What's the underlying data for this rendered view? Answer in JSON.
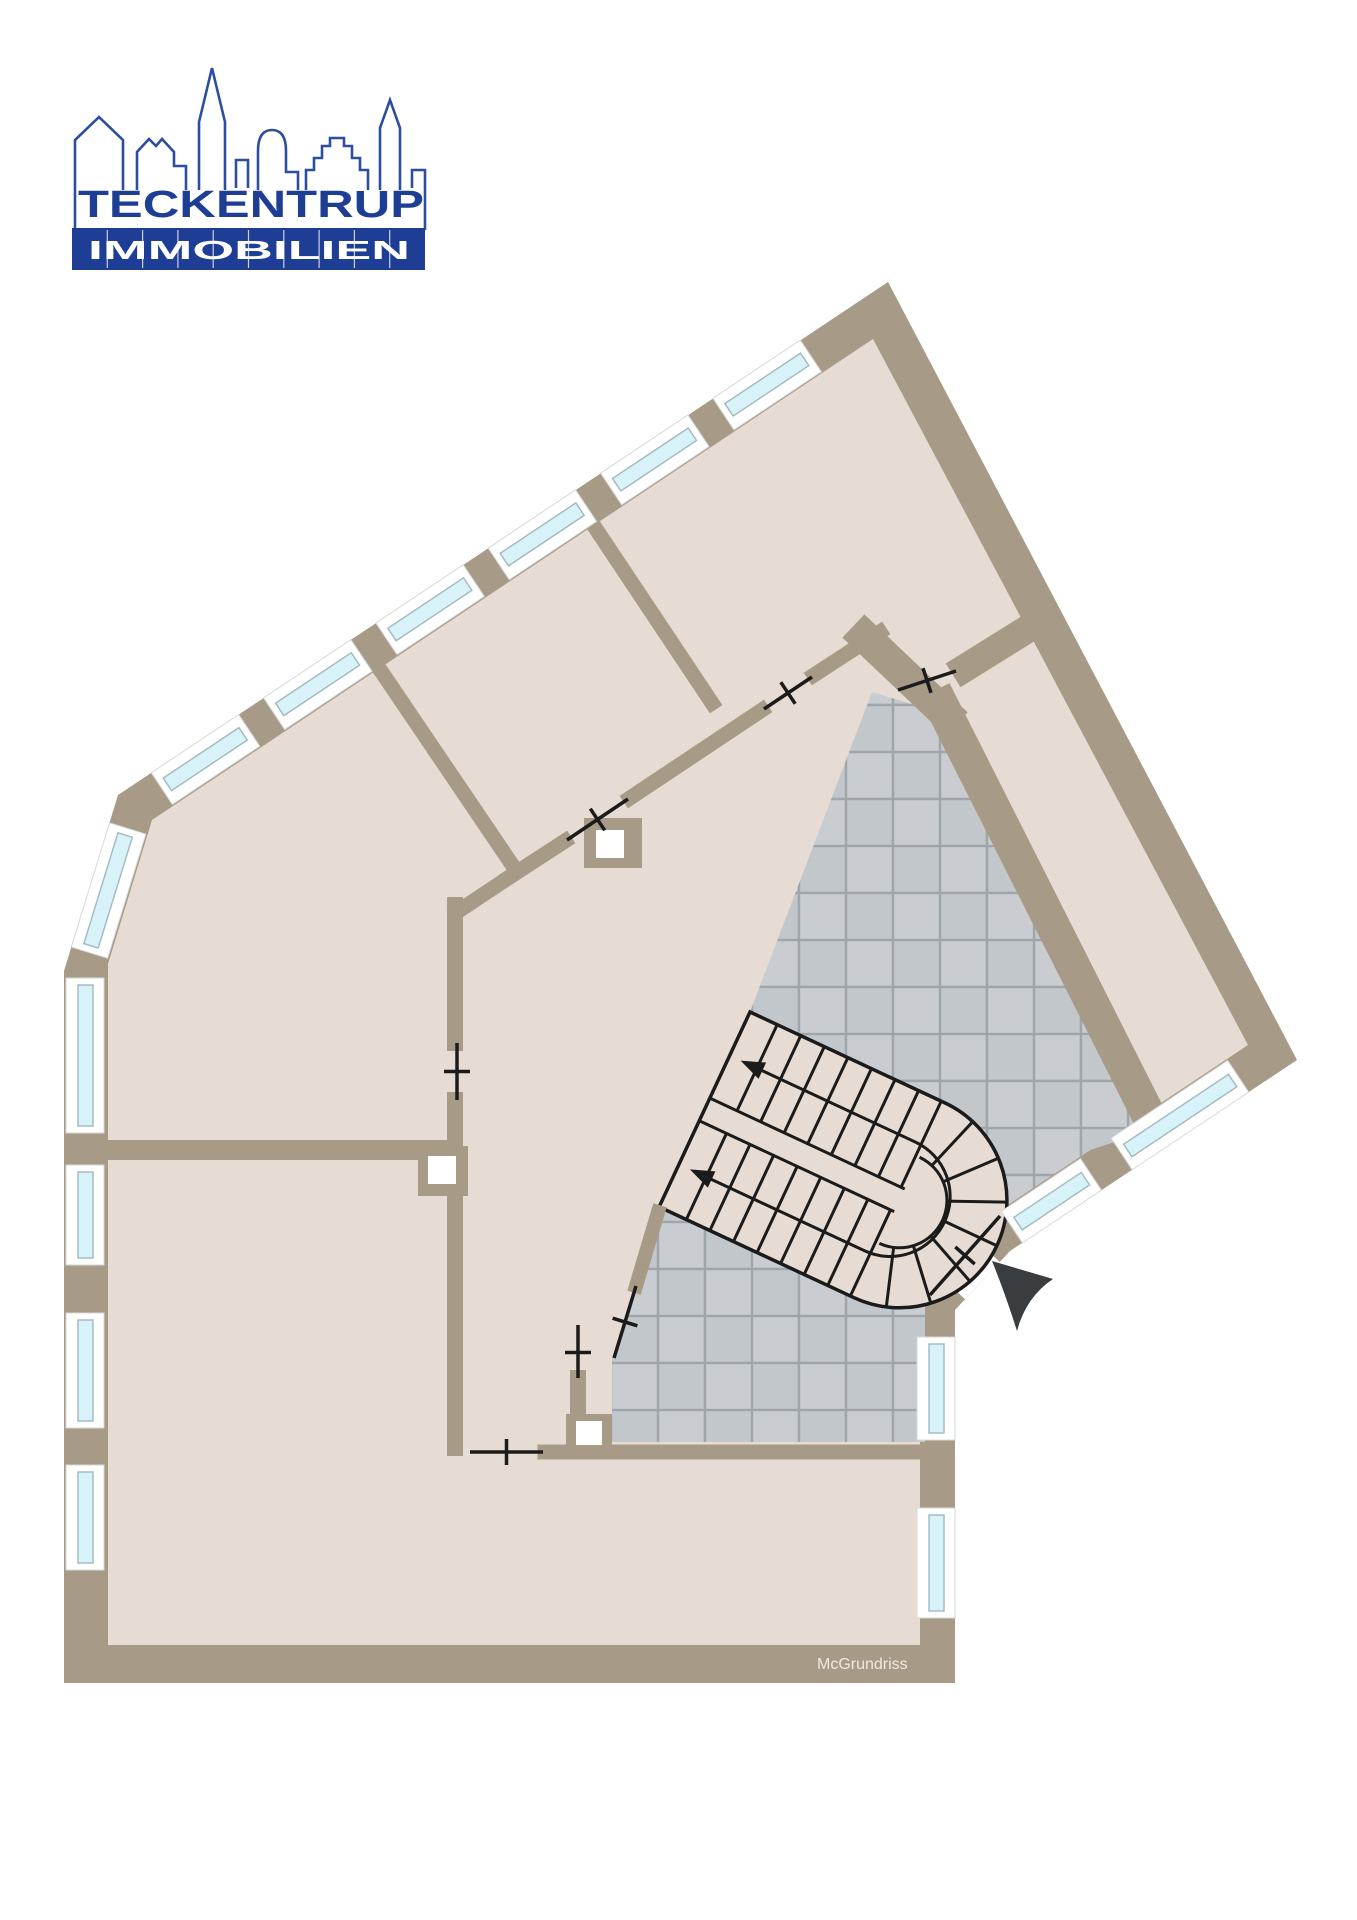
{
  "page": {
    "background": "#ffffff"
  },
  "logo": {
    "company": "TECKENTRUP",
    "division": "IMMOBILIEN",
    "text_blue": "#1e3d94",
    "banner_blue": "#1e3d94",
    "skyline_blue": "#2d4da1"
  },
  "floorplan": {
    "watermark": "McGrundriss",
    "colors": {
      "wall": "#a79a86",
      "room_floor": "#e7dcd4",
      "hall_tile_a": "#c9cdd1",
      "hall_tile_b": "#c2c7cb",
      "tile_grout": "#9fa6ab",
      "window_glass": "#d8f2f9",
      "window_frame": "#ffffff",
      "plan_lines": "#1b1b1b",
      "entrance_arrow": "#3a3d40",
      "shaft": "#ffffff",
      "watermark_text": "#efe9e1"
    },
    "icons": {
      "staircase": "double-flight-winder-staircase",
      "entrance_arrow": "entrance-direction-arrow"
    }
  }
}
